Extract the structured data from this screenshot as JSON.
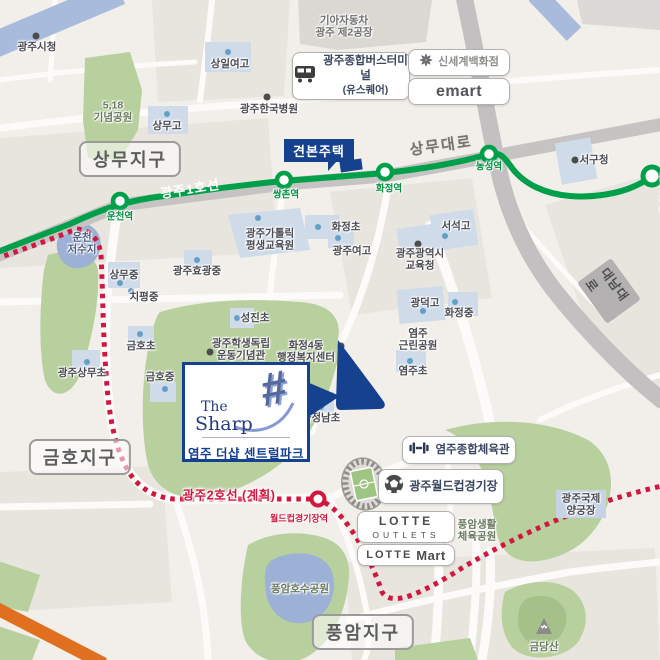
{
  "brand": {
    "the": "The",
    "sharp": "Sharp",
    "hash": "#",
    "name": "염주 더샵 센트럴파크"
  },
  "flag": {
    "label": "견본주택"
  },
  "districts": {
    "sangmu": "상무지구",
    "geumho": "금호지구",
    "pungam": "풍암지구"
  },
  "line1": {
    "label": "광주1호선",
    "color": "#00a04b",
    "stations": [
      "운천역",
      "쌍촌역",
      "화정역",
      "농성역",
      "돌고개역"
    ]
  },
  "line2": {
    "label": "광주2호선 (계획)",
    "station": "월드컵경기장역",
    "color": "#d1173f"
  },
  "roads": {
    "sangmu_daero": "상무대로",
    "daenam_daero": "대남대로"
  },
  "boxes": {
    "bus_terminal_line1": "광주종합버스터미널",
    "bus_terminal_line2": "(유스퀘어)",
    "shinsegae": "신세계백화점",
    "emart": "emart",
    "gym": "염주종합체육관",
    "worldcup_stadium": "광주월드컵경기장",
    "lotte_outlets_line1": "LOTTE",
    "lotte_outlets_line2": "OUTLETS",
    "lotte_mart_line1": "LOTTE",
    "lotte_mart_line2": "Mart"
  },
  "labels": {
    "cityhall": "광주시청",
    "park518": "5,18\n기념공원",
    "sangil_girls_hs": "상일여고",
    "sangmu_hs": "상무고",
    "hankook_hospital": "광주한국병원",
    "kia_factory": "기아자동차\n광주 제2공장",
    "seogu_office": "서구청",
    "seoseok_hs": "서석고",
    "edu_office": "광주광역시\n교육청",
    "ucheon_reservoir": "운천\n저수지",
    "sangmu_ms": "상무중",
    "chipyeong_ms": "치평중",
    "hyogwang_ms": "광주효광중",
    "catholic_center": "광주가톨릭\n평생교육원",
    "hwajeong_elem": "화정초",
    "gwangju_girls_hs": "광주여고",
    "seongjin_elem": "성진초",
    "geumho_elem": "금호초",
    "sangmu_elem": "광주상무초",
    "geumho_ms": "금호중",
    "memorial_hall": "광주학생독립\n운동기념관",
    "hwajeong4_center": "화정4동\n행정복지센터",
    "gwangdeok_hs": "광덕고",
    "hwajeong_ms": "화정중",
    "yeomju_park": "염주\n근린공원",
    "yeomju_elem": "염주초",
    "hwajeongnam_elem": "화정남초",
    "pungam_sports_park": "풍암생활\n체육공원",
    "archery_center": "광주국제\n양궁장",
    "pungam_lake": "풍암호수공원",
    "geumdang_mtn": "금당산"
  },
  "colors": {
    "navy": "#16418f",
    "line1_green": "#00a04b",
    "line2_red": "#d1173f",
    "park_green": "#b8cf9e",
    "water_blue": "#a3b6da",
    "road_gray": "#c6c3c3",
    "orange_road": "#e0701f"
  }
}
